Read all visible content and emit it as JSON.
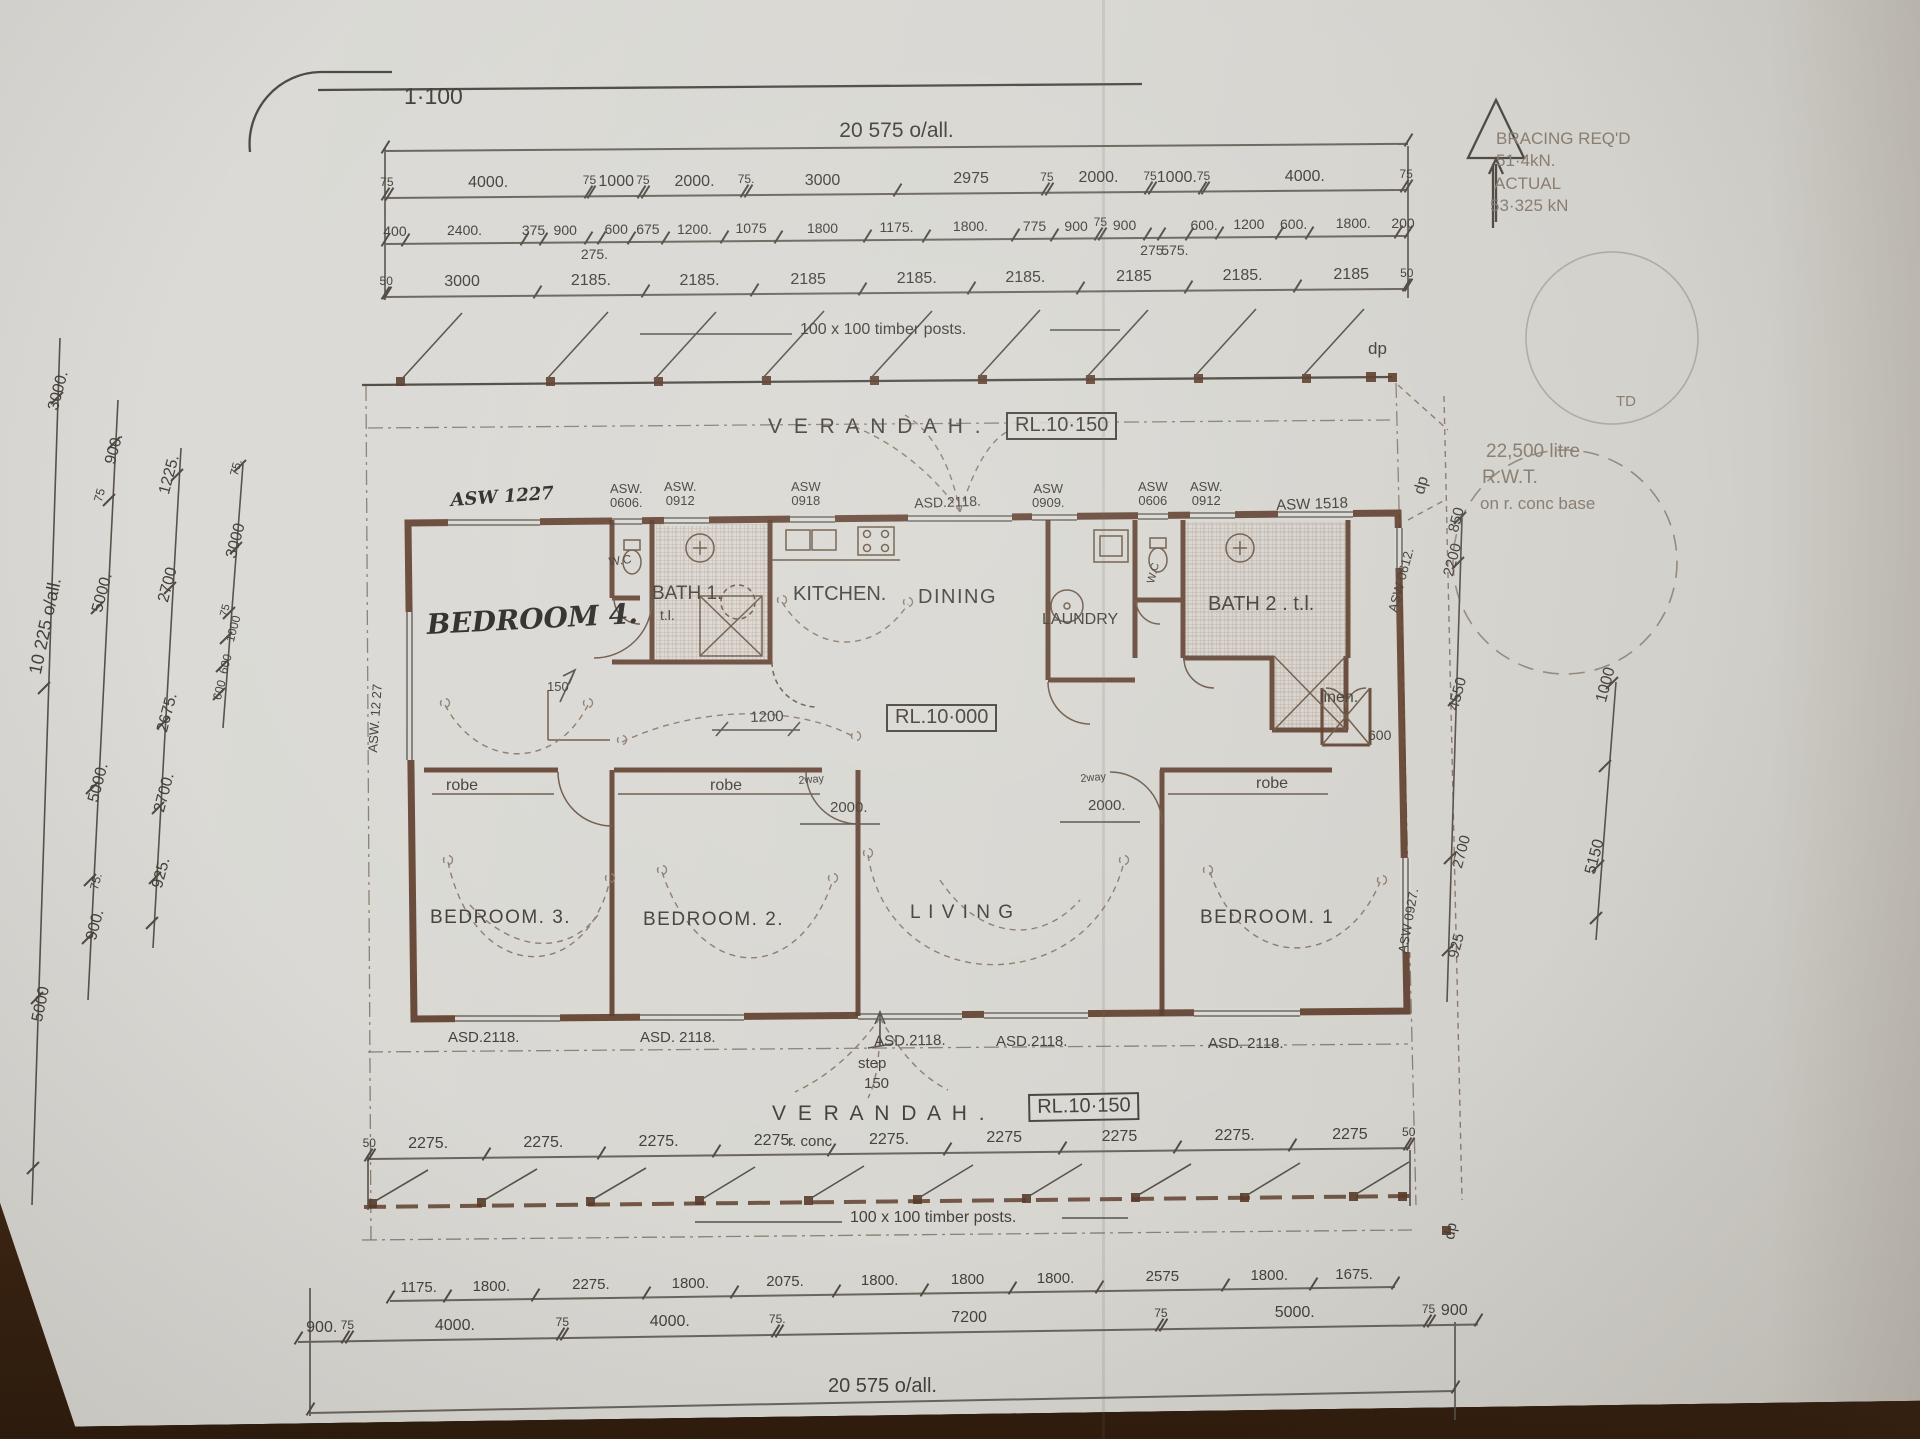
{
  "document_type": "hand-drawn house floor plan, scale 1:100, photographed on a wooden table",
  "labels": [
    {
      "n": "scale-note",
      "t": "1·100",
      "x": 404,
      "y": 84,
      "s": 23
    },
    {
      "n": "room-verandah-top",
      "t": "V E R A N D A H .",
      "x": 768,
      "y": 416,
      "s": 21,
      "c": "sp"
    },
    {
      "n": "level-verandah-top",
      "t": "RL.10·150",
      "x": 1006,
      "y": 412,
      "s": 20,
      "c": "box"
    },
    {
      "n": "room-bedroom4",
      "t": "BEDROOM 4.",
      "x": 426,
      "y": 610,
      "s": 28,
      "r": -3,
      "c": "hw"
    },
    {
      "n": "room-wc1",
      "t": "W.C",
      "x": 608,
      "y": 556,
      "s": 12,
      "r": -8
    },
    {
      "n": "room-bath1",
      "t": "BATH 1.",
      "x": 652,
      "y": 584,
      "s": 19
    },
    {
      "n": "room-bath1-tl",
      "t": "t.l.",
      "x": 660,
      "y": 608,
      "s": 14
    },
    {
      "n": "room-kitchen",
      "t": "KITCHEN.",
      "x": 793,
      "y": 584,
      "s": 20
    },
    {
      "n": "room-dining",
      "t": "DINING",
      "x": 918,
      "y": 587,
      "s": 20,
      "c": "sp1"
    },
    {
      "n": "room-laundry",
      "t": "LAUNDRY",
      "x": 1042,
      "y": 612,
      "s": 16
    },
    {
      "n": "room-wc2",
      "t": "W.C",
      "x": 1146,
      "y": 582,
      "s": 11,
      "r": -75
    },
    {
      "n": "room-bath2",
      "t": "BATH 2 . t.l.",
      "x": 1208,
      "y": 594,
      "s": 20
    },
    {
      "n": "room-linen",
      "t": "linen.",
      "x": 1320,
      "y": 690,
      "s": 16
    },
    {
      "n": "dim-linen-600",
      "t": "600",
      "x": 1368,
      "y": 728,
      "s": 14
    },
    {
      "n": "robe-1",
      "t": "robe",
      "x": 446,
      "y": 778,
      "s": 16
    },
    {
      "n": "robe-2",
      "t": "robe",
      "x": 710,
      "y": 778,
      "s": 16
    },
    {
      "n": "robe-3",
      "t": "robe",
      "x": 1256,
      "y": 776,
      "s": 16
    },
    {
      "n": "room-bedroom3",
      "t": "BEDROOM. 3.",
      "x": 430,
      "y": 908,
      "s": 19,
      "c": "sp1"
    },
    {
      "n": "room-bedroom2",
      "t": "BEDROOM. 2.",
      "x": 643,
      "y": 910,
      "s": 19,
      "c": "sp1"
    },
    {
      "n": "room-living",
      "t": "L I V I N G",
      "x": 910,
      "y": 903,
      "s": 19,
      "c": "sp1"
    },
    {
      "n": "room-bedroom1",
      "t": "BEDROOM. 1",
      "x": 1200,
      "y": 908,
      "s": 19,
      "c": "sp1"
    },
    {
      "n": "room-verandah-bottom",
      "t": "V E R A N D A H .",
      "x": 772,
      "y": 1103,
      "s": 21,
      "c": "sp"
    },
    {
      "n": "level-verandah-bottom",
      "t": "RL.10·150",
      "x": 1028,
      "y": 1094,
      "s": 20,
      "r": -1,
      "c": "box"
    },
    {
      "n": "note-r-conc",
      "t": "r. conc.",
      "x": 788,
      "y": 1134,
      "s": 15
    },
    {
      "n": "level-floor",
      "t": "RL.10·000",
      "x": 886,
      "y": 704,
      "s": 20,
      "c": "box"
    },
    {
      "n": "note-posts-top",
      "t": "100 x 100 timber posts.",
      "x": 800,
      "y": 322,
      "s": 16
    },
    {
      "n": "note-posts-bottom",
      "t": "100 x 100 timber posts.",
      "x": 850,
      "y": 1210,
      "s": 16
    },
    {
      "n": "note-bracing-1",
      "t": "BRACING REQ'D",
      "x": 1496,
      "y": 130,
      "s": 17,
      "c": "faint"
    },
    {
      "n": "note-bracing-2",
      "t": "51·4kN.",
      "x": 1496,
      "y": 152,
      "s": 17,
      "c": "faint"
    },
    {
      "n": "note-bracing-3",
      "t": "ACTUAL",
      "x": 1494,
      "y": 175,
      "s": 17,
      "c": "faint"
    },
    {
      "n": "note-bracing-4",
      "t": "53·325 kN",
      "x": 1490,
      "y": 197,
      "s": 17,
      "c": "faint"
    },
    {
      "n": "note-tank-1",
      "t": "22,500 litre",
      "x": 1486,
      "y": 442,
      "s": 19,
      "c": "faint"
    },
    {
      "n": "note-tank-2",
      "t": "R.W.T.",
      "x": 1482,
      "y": 468,
      "s": 19,
      "c": "faint"
    },
    {
      "n": "note-tank-3",
      "t": "on r. conc base",
      "x": 1480,
      "y": 495,
      "s": 17,
      "c": "faint"
    },
    {
      "n": "note-td",
      "t": "TD",
      "x": 1616,
      "y": 394,
      "s": 15,
      "c": "faint"
    },
    {
      "n": "note-dp-top",
      "t": "dp",
      "x": 1368,
      "y": 340,
      "s": 17
    },
    {
      "n": "note-dp-right",
      "t": "dp",
      "x": 1412,
      "y": 492,
      "s": 16,
      "r": -75
    },
    {
      "n": "note-dp-bottom",
      "t": "dp",
      "x": 1442,
      "y": 1238,
      "s": 15,
      "r": -80
    },
    {
      "n": "note-step",
      "t": "step",
      "x": 858,
      "y": 1056,
      "s": 15
    },
    {
      "n": "note-step-150",
      "t": "150",
      "x": 864,
      "y": 1076,
      "s": 15
    },
    {
      "n": "dim-hall-1200",
      "t": "1200",
      "x": 750,
      "y": 710,
      "s": 15,
      "r": -2
    },
    {
      "n": "dim-bed4-150",
      "t": "150",
      "x": 547,
      "y": 680,
      "s": 13
    },
    {
      "n": "note-2way-left",
      "t": "2way",
      "x": 798,
      "y": 776,
      "s": 11,
      "r": -5
    },
    {
      "n": "dim-2000-left",
      "t": "2000.",
      "x": 830,
      "y": 800,
      "s": 15
    },
    {
      "n": "note-2way-right",
      "t": "2way",
      "x": 1080,
      "y": 774,
      "s": 11,
      "r": -5
    },
    {
      "n": "dim-2000-right",
      "t": "2000.",
      "x": 1088,
      "y": 798,
      "s": 15
    },
    {
      "n": "win-asw1227-top",
      "t": "ASW 1227",
      "x": 450,
      "y": 492,
      "s": 18,
      "r": -4,
      "c": "hw"
    },
    {
      "n": "win-asw0606-a",
      "t": "ASW.\n0606.",
      "x": 610,
      "y": 482,
      "s": 13,
      "c": "pre"
    },
    {
      "n": "win-asw0912-a",
      "t": "ASW.\n0912",
      "x": 664,
      "y": 480,
      "s": 13,
      "c": "pre"
    },
    {
      "n": "win-asw0918",
      "t": "ASW\n0918",
      "x": 791,
      "y": 480,
      "s": 13,
      "c": "pre"
    },
    {
      "n": "door-asd2118-top",
      "t": "ASD.2118.",
      "x": 914,
      "y": 496,
      "s": 14,
      "r": -2
    },
    {
      "n": "win-asw0909",
      "t": "ASW\n0909.",
      "x": 1032,
      "y": 482,
      "s": 13,
      "c": "pre"
    },
    {
      "n": "win-asw0606-b",
      "t": "ASW\n0606",
      "x": 1138,
      "y": 480,
      "s": 13,
      "c": "pre"
    },
    {
      "n": "win-asw0912-b",
      "t": "ASW.\n0912",
      "x": 1190,
      "y": 480,
      "s": 13,
      "c": "pre"
    },
    {
      "n": "win-asw1518",
      "t": "ASW 1518",
      "x": 1276,
      "y": 498,
      "s": 15,
      "r": -2
    },
    {
      "n": "win-asw0612",
      "t": "ASW 0612.",
      "x": 1386,
      "y": 610,
      "s": 13,
      "r": -75
    },
    {
      "n": "win-asw1227-left",
      "t": "ASW. 12 27",
      "x": 366,
      "y": 752,
      "s": 13,
      "r": -86
    },
    {
      "n": "win-asw0927-right",
      "t": "ASW 0927.",
      "x": 1396,
      "y": 952,
      "s": 13,
      "r": -80
    },
    {
      "n": "door-asd2118-b1",
      "t": "ASD.2118.",
      "x": 448,
      "y": 1030,
      "s": 15
    },
    {
      "n": "door-asd2118-b2",
      "t": "ASD. 2118.",
      "x": 640,
      "y": 1030,
      "s": 15
    },
    {
      "n": "door-asd2118-b3",
      "t": "ASD.2118.",
      "x": 874,
      "y": 1034,
      "s": 15,
      "r": -1
    },
    {
      "n": "door-asd2118-b4",
      "t": "ASD.2118.",
      "x": 996,
      "y": 1034,
      "s": 15
    },
    {
      "n": "door-asd2118-b5",
      "t": "ASD. 2118.",
      "x": 1208,
      "y": 1036,
      "s": 15
    },
    {
      "n": "dim-left-3000-top",
      "t": "3000.",
      "x": 46,
      "y": 408,
      "s": 16,
      "r": -75
    },
    {
      "n": "dim-left-900-top",
      "t": "900.",
      "x": 103,
      "y": 462,
      "s": 16,
      "r": -75
    },
    {
      "n": "dim-left-75-a",
      "t": "75",
      "x": 92,
      "y": 500,
      "s": 12,
      "r": -75
    },
    {
      "n": "dim-left-1225",
      "t": "1225.",
      "x": 157,
      "y": 492,
      "s": 16,
      "r": -75
    },
    {
      "n": "dim-left-75-b",
      "t": "75.",
      "x": 228,
      "y": 474,
      "s": 12,
      "r": -75
    },
    {
      "n": "dim-left-3000-b",
      "t": "3000",
      "x": 224,
      "y": 556,
      "s": 16,
      "r": -75
    },
    {
      "n": "dim-left-5000-a",
      "t": "5000.",
      "x": 90,
      "y": 610,
      "s": 16,
      "r": -75
    },
    {
      "n": "dim-left-2700-a",
      "t": "2700",
      "x": 156,
      "y": 600,
      "s": 16,
      "r": -75
    },
    {
      "n": "dim-left-75-c",
      "t": "75",
      "x": 219,
      "y": 615,
      "s": 11,
      "r": -75
    },
    {
      "n": "dim-left-1000",
      "t": "1000",
      "x": 224,
      "y": 640,
      "s": 12,
      "r": -75
    },
    {
      "n": "dim-left-600-a",
      "t": "600",
      "x": 217,
      "y": 672,
      "s": 12,
      "r": -75
    },
    {
      "n": "dim-left-600-b",
      "t": "600",
      "x": 211,
      "y": 698,
      "s": 12,
      "r": -75
    },
    {
      "n": "dim-left-overall",
      "t": "10 225 o/all.",
      "x": 26,
      "y": 672,
      "s": 18,
      "r": -78
    },
    {
      "n": "dim-left-2675",
      "t": "2675.",
      "x": 155,
      "y": 730,
      "s": 16,
      "r": -75
    },
    {
      "n": "dim-left-5000-b",
      "t": "5000.",
      "x": 86,
      "y": 800,
      "s": 16,
      "r": -75
    },
    {
      "n": "dim-left-2700-b",
      "t": "2700.",
      "x": 152,
      "y": 810,
      "s": 16,
      "r": -75
    },
    {
      "n": "dim-left-925",
      "t": "925.",
      "x": 150,
      "y": 886,
      "s": 16,
      "r": -75
    },
    {
      "n": "dim-left-75-d",
      "t": "75.",
      "x": 88,
      "y": 888,
      "s": 12,
      "r": -75
    },
    {
      "n": "dim-left-900-b",
      "t": "900.",
      "x": 84,
      "y": 938,
      "s": 16,
      "r": -75
    },
    {
      "n": "dim-left-5000-c",
      "t": "5000",
      "x": 30,
      "y": 1020,
      "s": 16,
      "r": -78
    },
    {
      "n": "dim-right-850",
      "t": "850",
      "x": 1446,
      "y": 530,
      "s": 15,
      "r": -75
    },
    {
      "n": "dim-right-2200",
      "t": "2200",
      "x": 1441,
      "y": 574,
      "s": 15,
      "r": -75
    },
    {
      "n": "dim-right-4550",
      "t": "4550",
      "x": 1446,
      "y": 708,
      "s": 15,
      "r": -75
    },
    {
      "n": "dim-right-2700",
      "t": "2700",
      "x": 1450,
      "y": 866,
      "s": 15,
      "r": -75
    },
    {
      "n": "dim-right-925",
      "t": "925",
      "x": 1446,
      "y": 956,
      "s": 15,
      "r": -75
    },
    {
      "n": "dim-far-right-1000",
      "t": "1000",
      "x": 1594,
      "y": 700,
      "s": 16,
      "r": -75
    },
    {
      "n": "dim-far-right-5150",
      "t": "5150",
      "x": 1583,
      "y": 872,
      "s": 16,
      "r": -75
    }
  ],
  "dim_chains": [
    {
      "name": "top-overall",
      "x": 385,
      "y": 150,
      "len": 1023,
      "slope": -0.4,
      "values": [
        {
          "mm": 20575,
          "t": "20 575 o/all.",
          "fs": 21
        }
      ]
    },
    {
      "name": "top-row-1",
      "x": 385,
      "y": 197,
      "len": 1023,
      "slope": -0.45,
      "values": [
        {
          "mm": 75,
          "t": "75",
          "sm": true
        },
        {
          "mm": 4000,
          "t": "4000."
        },
        {
          "mm": 75,
          "t": "75",
          "sm": true
        },
        {
          "mm": 1000,
          "t": "1000"
        },
        {
          "mm": 75,
          "t": "75",
          "sm": true
        },
        {
          "mm": 2000,
          "t": "2000."
        },
        {
          "mm": 75,
          "t": "75.",
          "sm": true
        },
        {
          "mm": 3000,
          "t": "3000"
        },
        {
          "mm": 2975,
          "t": "2975"
        },
        {
          "mm": 75,
          "t": "75",
          "sm": true
        },
        {
          "mm": 2000,
          "t": "2000."
        },
        {
          "mm": 75,
          "t": "75",
          "sm": true
        },
        {
          "mm": 1000,
          "t": "1000."
        },
        {
          "mm": 75,
          "t": "75",
          "sm": true
        },
        {
          "mm": 4000,
          "t": "4000."
        },
        {
          "mm": 75,
          "t": "75",
          "sm": true
        }
      ]
    },
    {
      "name": "top-row-2",
      "x": 385,
      "y": 243,
      "len": 1023,
      "slope": -0.45,
      "fs": 14,
      "values": [
        {
          "mm": 400,
          "t": "400"
        },
        {
          "mm": 2400,
          "t": "2400."
        },
        {
          "mm": 375,
          "t": "375"
        },
        {
          "mm": 900,
          "t": "900"
        },
        {
          "mm": 275,
          "t": "275.",
          "below": true
        },
        {
          "mm": 600,
          "t": "600"
        },
        {
          "mm": 675,
          "t": "675"
        },
        {
          "mm": 1200,
          "t": "1200."
        },
        {
          "mm": 1075,
          "t": "1075"
        },
        {
          "mm": 1800,
          "t": "1800"
        },
        {
          "mm": 1175,
          "t": "1175."
        },
        {
          "mm": 1800,
          "t": "1800."
        },
        {
          "mm": 775,
          "t": "775"
        },
        {
          "mm": 900,
          "t": "900"
        },
        {
          "mm": 75,
          "t": "75",
          "sm": true
        },
        {
          "mm": 900,
          "t": "900"
        },
        {
          "mm": 275,
          "t": "275.",
          "below": true
        },
        {
          "mm": 575,
          "t": "575.",
          "below": true
        },
        {
          "mm": 600,
          "t": "600."
        },
        {
          "mm": 1200,
          "t": "1200"
        },
        {
          "mm": 600,
          "t": "600."
        },
        {
          "mm": 1800,
          "t": "1800."
        },
        {
          "mm": 200,
          "t": "200"
        }
      ]
    },
    {
      "name": "top-row-3",
      "x": 385,
      "y": 296,
      "len": 1023,
      "slope": -0.45,
      "values": [
        {
          "mm": 50,
          "t": "50",
          "sm": true
        },
        {
          "mm": 3000,
          "t": "3000"
        },
        {
          "mm": 2185,
          "t": "2185."
        },
        {
          "mm": 2185,
          "t": "2185."
        },
        {
          "mm": 2185,
          "t": "2185"
        },
        {
          "mm": 2185,
          "t": "2185."
        },
        {
          "mm": 2185,
          "t": "2185."
        },
        {
          "mm": 2185,
          "t": "2185"
        },
        {
          "mm": 2185,
          "t": "2185."
        },
        {
          "mm": 2185,
          "t": "2185"
        },
        {
          "mm": 50,
          "t": "50",
          "sm": true
        }
      ]
    },
    {
      "name": "bottom-posts-row",
      "x": 368,
      "y": 1158,
      "len": 1042,
      "slope": -0.6,
      "values": [
        {
          "mm": 50,
          "t": "50",
          "sm": true
        },
        {
          "mm": 2275,
          "t": "2275."
        },
        {
          "mm": 2275,
          "t": "2275."
        },
        {
          "mm": 2275,
          "t": "2275."
        },
        {
          "mm": 2275,
          "t": "2275."
        },
        {
          "mm": 2275,
          "t": "2275."
        },
        {
          "mm": 2275,
          "t": "2275"
        },
        {
          "mm": 2275,
          "t": "2275"
        },
        {
          "mm": 2275,
          "t": "2275."
        },
        {
          "mm": 2275,
          "t": "2275"
        },
        {
          "mm": 50,
          "t": "50",
          "sm": true
        }
      ]
    },
    {
      "name": "bottom-row-1",
      "x": 390,
      "y": 1300,
      "len": 1005,
      "slope": -0.8,
      "fs": 15,
      "values": [
        {
          "mm": 1175,
          "t": "1175."
        },
        {
          "mm": 1800,
          "t": "1800."
        },
        {
          "mm": 2275,
          "t": "2275."
        },
        {
          "mm": 1800,
          "t": "1800."
        },
        {
          "mm": 2075,
          "t": "2075."
        },
        {
          "mm": 1800,
          "t": "1800."
        },
        {
          "mm": 1800,
          "t": "1800"
        },
        {
          "mm": 1800,
          "t": "1800."
        },
        {
          "mm": 2575,
          "t": "2575"
        },
        {
          "mm": 1800,
          "t": "1800."
        },
        {
          "mm": 1675,
          "t": "1675."
        }
      ]
    },
    {
      "name": "bottom-row-2",
      "x": 298,
      "y": 1341,
      "len": 1180,
      "slope": -0.85,
      "values": [
        {
          "mm": 900,
          "t": "900."
        },
        {
          "mm": 75,
          "t": "75",
          "sm": true
        },
        {
          "mm": 4000,
          "t": "4000."
        },
        {
          "mm": 75,
          "t": "75",
          "sm": true
        },
        {
          "mm": 4000,
          "t": "4000."
        },
        {
          "mm": 75,
          "t": "75.",
          "sm": true
        },
        {
          "mm": 7200,
          "t": "7200"
        },
        {
          "mm": 75,
          "t": "75",
          "sm": true
        },
        {
          "mm": 5000,
          "t": "5000."
        },
        {
          "mm": 75,
          "t": "75",
          "sm": true
        },
        {
          "mm": 900,
          "t": "900"
        }
      ]
    },
    {
      "name": "bottom-overall",
      "x": 310,
      "y": 1412,
      "len": 1145,
      "slope": -1.1,
      "values": [
        {
          "mm": 20575,
          "t": "20 575 o/all.",
          "fs": 20
        }
      ]
    }
  ]
}
